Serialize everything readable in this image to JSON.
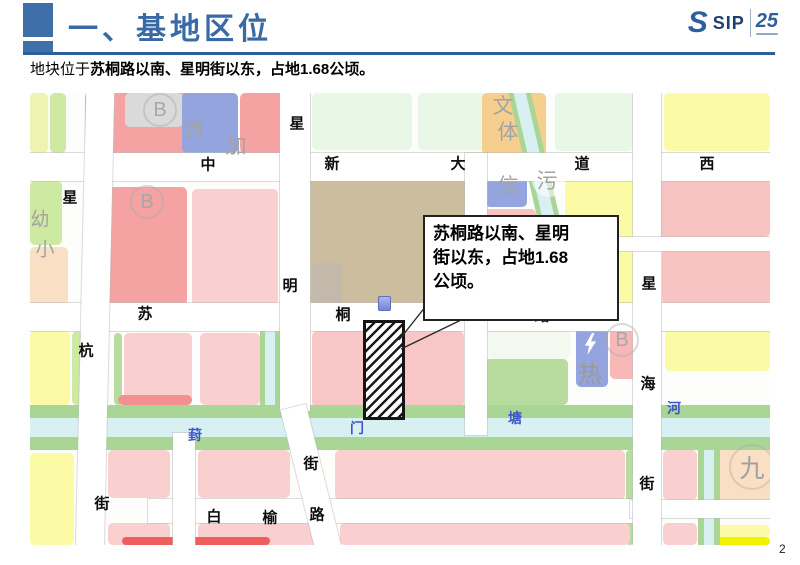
{
  "header": {
    "title": "一、基地区位",
    "logo": {
      "s": "S",
      "name": "SIP",
      "anniv": "25"
    }
  },
  "subtitle": {
    "prefix": "地块位于",
    "emphasis": "苏桐路以南、星明街以东，占地1.68公顷。"
  },
  "callout": {
    "lines": [
      "苏桐路以南、星明",
      "街以东，占地1.68",
      "公顷。"
    ],
    "x": 393,
    "y": 122,
    "w": 176,
    "h": 92,
    "leaders": [
      [
        396,
        213,
        369,
        247
      ],
      [
        458,
        214,
        371,
        256
      ]
    ]
  },
  "page_number": "2",
  "colors": {
    "accent_blue": "#3f6fa8",
    "road": "#ffffff",
    "water": "#d9f0f2",
    "green_band": "#a9d694"
  },
  "map": {
    "parcels": [
      {
        "x": 0,
        "y": 0,
        "w": 18,
        "h": 60,
        "c": "#eef3b2"
      },
      {
        "x": 20,
        "y": 0,
        "w": 16,
        "h": 60,
        "c": "#cde9a2"
      },
      {
        "x": 55,
        "y": 0,
        "w": 122,
        "h": 60,
        "c": "#f5a2a2"
      },
      {
        "x": 95,
        "y": 0,
        "w": 58,
        "h": 34,
        "c": "#dadada"
      },
      {
        "x": 152,
        "y": 0,
        "w": 56,
        "h": 60,
        "c": "#93a4de"
      },
      {
        "x": 210,
        "y": 0,
        "w": 44,
        "h": 60,
        "c": "#f5a2a2"
      },
      {
        "x": 282,
        "y": 0,
        "w": 100,
        "h": 57,
        "c": "#e9f7e6"
      },
      {
        "x": 388,
        "y": 0,
        "w": 112,
        "h": 57,
        "c": "#e9f7e6"
      },
      {
        "x": 452,
        "y": 0,
        "w": 64,
        "h": 62,
        "c": "#f6cf8e"
      },
      {
        "x": 525,
        "y": 0,
        "w": 78,
        "h": 58,
        "c": "#e9f7e6"
      },
      {
        "x": 634,
        "y": 0,
        "w": 106,
        "h": 58,
        "c": "#fbfba6"
      },
      {
        "x": 0,
        "y": 88,
        "w": 32,
        "h": 64,
        "c": "#cde9a2"
      },
      {
        "x": 0,
        "y": 154,
        "w": 38,
        "h": 58,
        "c": "#f9dfc3"
      },
      {
        "x": 75,
        "y": 94,
        "w": 82,
        "h": 118,
        "c": "#f5a2a2"
      },
      {
        "x": 162,
        "y": 96,
        "w": 86,
        "h": 116,
        "c": "#f9cfcf"
      },
      {
        "x": 280,
        "y": 80,
        "w": 158,
        "h": 132,
        "c": "#cdbd9f"
      },
      {
        "x": 282,
        "y": 170,
        "w": 30,
        "h": 42,
        "c": "#c2b9ab"
      },
      {
        "x": 455,
        "y": 74,
        "w": 42,
        "h": 40,
        "c": "#93a4de"
      },
      {
        "x": 452,
        "y": 116,
        "w": 54,
        "h": 96,
        "c": "#f8c3c3"
      },
      {
        "x": 535,
        "y": 80,
        "w": 76,
        "h": 64,
        "c": "#fbfba6"
      },
      {
        "x": 628,
        "y": 78,
        "w": 112,
        "h": 66,
        "c": "#f8c3c3"
      },
      {
        "x": 535,
        "y": 158,
        "w": 74,
        "h": 54,
        "c": "#fbfba6"
      },
      {
        "x": 632,
        "y": 155,
        "w": 108,
        "h": 57,
        "c": "#f8c3c3"
      },
      {
        "x": 0,
        "y": 238,
        "w": 40,
        "h": 74,
        "c": "#fbfba6"
      },
      {
        "x": 42,
        "y": 238,
        "w": 10,
        "h": 74,
        "c": "#cde9a2"
      },
      {
        "x": 84,
        "y": 240,
        "w": 8,
        "h": 72,
        "c": "#b7dc9e"
      },
      {
        "x": 94,
        "y": 240,
        "w": 68,
        "h": 72,
        "c": "#f9cfcf"
      },
      {
        "x": 170,
        "y": 240,
        "w": 60,
        "h": 72,
        "c": "#f9cfcf"
      },
      {
        "x": 282,
        "y": 238,
        "w": 152,
        "h": 76,
        "c": "#f8c6c6"
      },
      {
        "x": 458,
        "y": 228,
        "w": 82,
        "h": 38,
        "c": "#f3f9ee"
      },
      {
        "x": 448,
        "y": 266,
        "w": 90,
        "h": 46,
        "c": "#b7dc9e"
      },
      {
        "x": 546,
        "y": 228,
        "w": 32,
        "h": 66,
        "c": "#93a4de"
      },
      {
        "x": 580,
        "y": 228,
        "w": 34,
        "h": 58,
        "c": "#f8b8b8"
      },
      {
        "x": 635,
        "y": 226,
        "w": 105,
        "h": 52,
        "c": "#fbfba6"
      },
      {
        "x": 0,
        "y": 360,
        "w": 44,
        "h": 92,
        "c": "#fbfba6"
      },
      {
        "x": 88,
        "y": 302,
        "w": 74,
        "h": 10,
        "c": "#f39090"
      },
      {
        "x": 78,
        "y": 357,
        "w": 62,
        "h": 48,
        "c": "#f9cfcf"
      },
      {
        "x": 168,
        "y": 357,
        "w": 92,
        "h": 48,
        "c": "#f9cfcf"
      },
      {
        "x": 305,
        "y": 357,
        "w": 290,
        "h": 50,
        "c": "#f9cfcf"
      },
      {
        "x": 596,
        "y": 357,
        "w": 8,
        "h": 95,
        "c": "#b7dc9e"
      },
      {
        "x": 633,
        "y": 357,
        "w": 34,
        "h": 50,
        "c": "#f9cfcf"
      },
      {
        "x": 686,
        "y": 352,
        "w": 54,
        "h": 68,
        "c": "#f9dfc3"
      },
      {
        "x": 78,
        "y": 430,
        "w": 62,
        "h": 22,
        "c": "#f9cfcf"
      },
      {
        "x": 168,
        "y": 430,
        "w": 120,
        "h": 22,
        "c": "#f9cfcf"
      },
      {
        "x": 310,
        "y": 430,
        "w": 290,
        "h": 22,
        "c": "#f9cfcf"
      },
      {
        "x": 633,
        "y": 430,
        "w": 34,
        "h": 22,
        "c": "#f9cfcf"
      },
      {
        "x": 686,
        "y": 432,
        "w": 54,
        "h": 12,
        "c": "#fbfba6"
      },
      {
        "x": 686,
        "y": 444,
        "w": 54,
        "h": 8,
        "c": "#f2f200"
      },
      {
        "x": 92,
        "y": 444,
        "w": 148,
        "h": 8,
        "c": "#ee5f5f"
      }
    ],
    "canals": [
      {
        "x": 0,
        "y": 312,
        "w": 740,
        "h": 13,
        "c": "#a9d694"
      },
      {
        "x": 0,
        "y": 325,
        "w": 740,
        "h": 19,
        "c": "#d9f0f2"
      },
      {
        "x": 0,
        "y": 344,
        "w": 740,
        "h": 13,
        "c": "#a9d694"
      },
      {
        "x": 230,
        "y": 210,
        "w": 20,
        "h": 102,
        "c": "linear-gradient(90deg,#a9d694 0 5px,#d9f0f2 5px 15px,#a9d694 15px 20px)"
      },
      {
        "x": 668,
        "y": 357,
        "w": 22,
        "h": 95,
        "c": "linear-gradient(90deg,#a9d694 0 6px,#d9f0f2 6px 16px,#a9d694 16px 22px)"
      },
      {
        "x": 493,
        "y": -8,
        "w": 22,
        "h": 140,
        "c": "linear-gradient(90deg,#a9d694 0 5px,#d9f0f2 5px 17px,#a9d694 17px 22px)",
        "r": -13
      }
    ],
    "roads": [
      {
        "x": 0,
        "y": 60,
        "w": 740,
        "h": 28
      },
      {
        "x": 0,
        "y": 210,
        "w": 740,
        "h": 28
      },
      {
        "x": 118,
        "y": 406,
        "w": 500,
        "h": 24
      },
      {
        "x": 600,
        "y": 407,
        "w": 140,
        "h": 18
      },
      {
        "x": 51,
        "y": -10,
        "w": 28,
        "h": 480,
        "r": 1.3
      },
      {
        "x": 250,
        "y": 0,
        "w": 30,
        "h": 318
      },
      {
        "x": 268,
        "y": 312,
        "w": 26,
        "h": 148,
        "r": -14
      },
      {
        "x": 603,
        "y": 0,
        "w": 28,
        "h": 452
      },
      {
        "x": 435,
        "y": 60,
        "w": 22,
        "h": 282
      },
      {
        "x": 143,
        "y": 340,
        "w": 22,
        "h": 112
      },
      {
        "x": 535,
        "y": 144,
        "w": 205,
        "h": 14
      }
    ],
    "extras": [
      {
        "kind": "wcircle",
        "x": 502,
        "y": 70,
        "w": 34,
        "h": 34
      },
      {
        "kind": "site-hatch",
        "x": 333,
        "y": 227,
        "w": 36,
        "h": 94
      },
      {
        "kind": "marker",
        "x": 348,
        "y": 203,
        "w": 11,
        "h": 13
      },
      {
        "kind": "bolt",
        "x": 552,
        "y": 240,
        "w": 16,
        "h": 22
      }
    ],
    "labels": [
      {
        "t": "中",
        "x": 178,
        "y": 71,
        "k": "r"
      },
      {
        "t": "新",
        "x": 302,
        "y": 70,
        "k": "r"
      },
      {
        "t": "大",
        "x": 428,
        "y": 70,
        "k": "r"
      },
      {
        "t": "道",
        "x": 552,
        "y": 70,
        "k": "r"
      },
      {
        "t": "西",
        "x": 677,
        "y": 70,
        "k": "r"
      },
      {
        "t": "苏",
        "x": 115,
        "y": 220,
        "k": "r"
      },
      {
        "t": "桐",
        "x": 313,
        "y": 221,
        "k": "r"
      },
      {
        "t": "路",
        "x": 512,
        "y": 222,
        "k": "r"
      },
      {
        "t": "白",
        "x": 184,
        "y": 423,
        "k": "r"
      },
      {
        "t": "榆",
        "x": 240,
        "y": 424,
        "k": "r"
      },
      {
        "t": "路",
        "x": 287,
        "y": 421,
        "k": "r"
      },
      {
        "t": "星",
        "x": 40,
        "y": 104,
        "k": "r"
      },
      {
        "t": "杭",
        "x": 56,
        "y": 257,
        "k": "r"
      },
      {
        "t": "街",
        "x": 72,
        "y": 410,
        "k": "r"
      },
      {
        "t": "星",
        "x": 267,
        "y": 30,
        "k": "r"
      },
      {
        "t": "明",
        "x": 260,
        "y": 192,
        "k": "r"
      },
      {
        "t": "街",
        "x": 281,
        "y": 370,
        "k": "r"
      },
      {
        "t": "星",
        "x": 619,
        "y": 190,
        "k": "r"
      },
      {
        "t": "海",
        "x": 618,
        "y": 290,
        "k": "r"
      },
      {
        "t": "街",
        "x": 617,
        "y": 390,
        "k": "r"
      },
      {
        "t": "葑",
        "x": 165,
        "y": 342,
        "k": "w"
      },
      {
        "t": "门",
        "x": 327,
        "y": 335,
        "k": "w"
      },
      {
        "t": "塘",
        "x": 485,
        "y": 325,
        "k": "w"
      },
      {
        "t": "河",
        "x": 644,
        "y": 315,
        "k": "w"
      },
      {
        "t": "消",
        "x": 163,
        "y": 36,
        "k": "g22"
      },
      {
        "t": "加",
        "x": 206,
        "y": 52,
        "k": "g22"
      },
      {
        "t": "文",
        "x": 473,
        "y": 12,
        "k": "g22"
      },
      {
        "t": "体",
        "x": 478,
        "y": 38,
        "k": "g22"
      },
      {
        "t": "信",
        "x": 478,
        "y": 92,
        "k": "g22"
      },
      {
        "t": "污",
        "x": 517,
        "y": 87,
        "k": "g22"
      },
      {
        "t": "热",
        "x": 560,
        "y": 279,
        "k": "g24"
      },
      {
        "t": "幼",
        "x": 10,
        "y": 125,
        "k": "g20"
      },
      {
        "t": "小",
        "x": 15,
        "y": 155,
        "k": "g20"
      },
      {
        "t": "B",
        "x": 130,
        "y": 17,
        "k": "b"
      },
      {
        "t": "B",
        "x": 117,
        "y": 109,
        "k": "b"
      },
      {
        "t": "B",
        "x": 592,
        "y": 247,
        "k": "b"
      },
      {
        "t": "九",
        "x": 722,
        "y": 374,
        "k": "G"
      }
    ]
  }
}
